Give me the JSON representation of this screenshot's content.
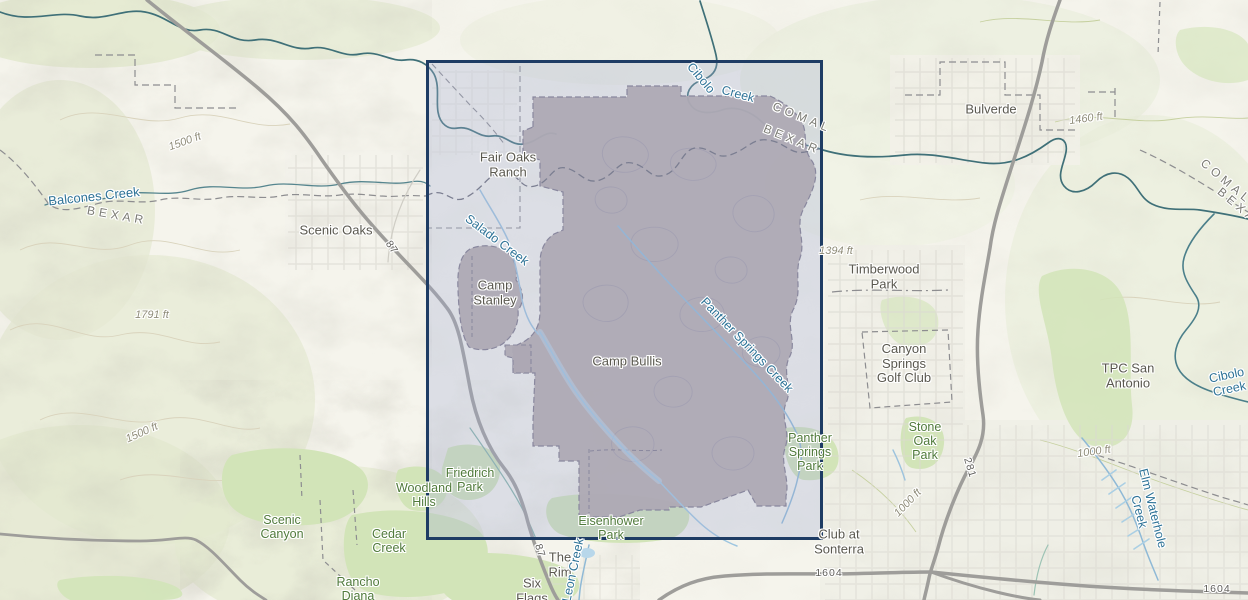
{
  "map": {
    "description_labels_note": "topographic basemap labels visible in viewport",
    "colors": {
      "selection_border": "#1e3c64",
      "selection_fill": "rgba(163,173,212,0.30)",
      "military_polygon_fill": "#b2a8a6",
      "water_label": "#2e7397",
      "park_label": "#507a3b",
      "place_label": "#5a584f",
      "county_label": "#7b7b74",
      "elevation_label": "#8f8c79",
      "road_line": "#9e9d9a",
      "park_fill": "#d2e4b8",
      "creek_line": "#3f7078"
    }
  },
  "map_labels": [
    {
      "name": "balcones-creek",
      "cls": "water",
      "text": "Balcones Creek",
      "x": 94,
      "y": 197,
      "rot": -6,
      "fs": 13
    },
    {
      "name": "bexar-county-west",
      "cls": "county",
      "text": "BEXAR",
      "x": 117,
      "y": 216,
      "rot": 10
    },
    {
      "name": "scenic-oaks",
      "cls": "place",
      "text": "Scenic Oaks",
      "x": 336,
      "y": 231,
      "rot": 0
    },
    {
      "name": "elev-1791",
      "cls": "elev",
      "text": "1791 ft",
      "x": 152,
      "y": 315,
      "rot": 0
    },
    {
      "name": "elev-1500-a",
      "cls": "elev",
      "text": "1500 ft",
      "x": 185,
      "y": 142,
      "rot": -20
    },
    {
      "name": "elev-1500-b",
      "cls": "elev",
      "text": "1500 ft",
      "x": 142,
      "y": 433,
      "rot": -24
    },
    {
      "name": "fair-oaks-ranch",
      "cls": "place",
      "text": "Fair Oaks\nRanch",
      "x": 508,
      "y": 165,
      "rot": 0
    },
    {
      "name": "salado-creek",
      "cls": "water",
      "text": "Salado Creek",
      "x": 497,
      "y": 240,
      "rot": 37
    },
    {
      "name": "camp-stanley",
      "cls": "place",
      "text": "Camp\nStanley",
      "x": 495,
      "y": 293,
      "rot": 0
    },
    {
      "name": "camp-bullis",
      "cls": "place",
      "text": "Camp Bullis",
      "x": 627,
      "y": 362,
      "rot": 0
    },
    {
      "name": "cibolo-creek-top-1",
      "cls": "water",
      "text": "Cibolo",
      "x": 701,
      "y": 78,
      "rot": 50
    },
    {
      "name": "cibolo-creek-top-2",
      "cls": "water",
      "text": "Creek",
      "x": 738,
      "y": 94,
      "rot": 15
    },
    {
      "name": "comal-county-ne",
      "cls": "county",
      "text": "COMAL",
      "x": 802,
      "y": 118,
      "rot": 22
    },
    {
      "name": "bexar-county-ne",
      "cls": "county",
      "text": "BEXAR",
      "x": 792,
      "y": 140,
      "rot": 22
    },
    {
      "name": "bulverde",
      "cls": "place",
      "text": "Bulverde",
      "x": 991,
      "y": 110,
      "rot": 0
    },
    {
      "name": "elev-1460",
      "cls": "elev",
      "text": "1460 ft",
      "x": 1086,
      "y": 119,
      "rot": -8
    },
    {
      "name": "comal-county-east",
      "cls": "county",
      "text": "COMAL",
      "x": 1226,
      "y": 182,
      "rot": 40
    },
    {
      "name": "bexar-county-east",
      "cls": "county",
      "text": "BEXAR",
      "x": 1242,
      "y": 210,
      "rot": 40
    },
    {
      "name": "elev-1394",
      "cls": "elev",
      "text": "1394 ft",
      "x": 836,
      "y": 251,
      "rot": 0
    },
    {
      "name": "timberwood-park",
      "cls": "place",
      "text": "Timberwood\nPark",
      "x": 884,
      "y": 277,
      "rot": 0
    },
    {
      "name": "canyon-springs-golf-club",
      "cls": "place",
      "text": "Canyon\nSprings\nGolf Club",
      "x": 904,
      "y": 364,
      "rot": 0
    },
    {
      "name": "tpc-san-antonio",
      "cls": "place",
      "text": "TPC San\nAntonio",
      "x": 1128,
      "y": 376,
      "rot": 0
    },
    {
      "name": "cibolo-creek-right",
      "cls": "water",
      "text": "Cibolo Creek",
      "x": 1228,
      "y": 382,
      "rot": -12
    },
    {
      "name": "panther-springs-creek",
      "cls": "water",
      "text": "Panther Springs Creek",
      "x": 747,
      "y": 345,
      "rot": 46
    },
    {
      "name": "panther-springs-park",
      "cls": "park",
      "text": "Panther\nSprings\nPark",
      "x": 810,
      "y": 452,
      "rot": 0
    },
    {
      "name": "stone-oak-park",
      "cls": "park",
      "text": "Stone\nOak\nPark",
      "x": 925,
      "y": 441,
      "rot": 0
    },
    {
      "name": "elev-1000-a",
      "cls": "elev",
      "text": "1000 ft",
      "x": 1094,
      "y": 452,
      "rot": -8
    },
    {
      "name": "elev-1000-b",
      "cls": "elev",
      "text": "1000 ft",
      "x": 908,
      "y": 503,
      "rot": -46
    },
    {
      "name": "elm-waterhole-creek",
      "cls": "water",
      "text": "Elm Waterhole Creek",
      "x": 1146,
      "y": 510,
      "rot": 76
    },
    {
      "name": "route-281",
      "cls": "road",
      "text": "281",
      "x": 969,
      "y": 468,
      "rot": 73
    },
    {
      "name": "route-87-north",
      "cls": "road",
      "text": "87",
      "x": 391,
      "y": 248,
      "rot": 55
    },
    {
      "name": "route-87-south",
      "cls": "road",
      "text": "87",
      "x": 539,
      "y": 551,
      "rot": 73
    },
    {
      "name": "route-1604-west",
      "cls": "road",
      "text": "1604",
      "x": 829,
      "y": 574,
      "rot": 0
    },
    {
      "name": "route-1604-east",
      "cls": "road",
      "text": "1604",
      "x": 1217,
      "y": 590,
      "rot": 0
    },
    {
      "name": "club-at-sonterra",
      "cls": "place",
      "text": "Club at\nSonterra",
      "x": 839,
      "y": 542,
      "rot": 0
    },
    {
      "name": "eisenhower-park",
      "cls": "park",
      "text": "Eisenhower\nPark",
      "x": 611,
      "y": 528,
      "rot": 0
    },
    {
      "name": "friedrich-park",
      "cls": "park",
      "text": "Friedrich\nPark",
      "x": 470,
      "y": 480,
      "rot": 0
    },
    {
      "name": "woodland-hills",
      "cls": "park",
      "text": "Woodland\nHills",
      "x": 424,
      "y": 495,
      "rot": 0
    },
    {
      "name": "scenic-canyon",
      "cls": "park",
      "text": "Scenic\nCanyon",
      "x": 282,
      "y": 527,
      "rot": 0
    },
    {
      "name": "cedar-creek",
      "cls": "park",
      "text": "Cedar\nCreek",
      "x": 389,
      "y": 541,
      "rot": 0
    },
    {
      "name": "rancho-diana",
      "cls": "park",
      "text": "Rancho\nDiana",
      "x": 358,
      "y": 589,
      "rot": 0
    },
    {
      "name": "the-rim",
      "cls": "place",
      "text": "The\nRim",
      "x": 560,
      "y": 565,
      "rot": 0
    },
    {
      "name": "six-flags",
      "cls": "place",
      "text": "Six\nFlags",
      "x": 532,
      "y": 591,
      "rot": 0
    },
    {
      "name": "leon-creek",
      "cls": "water",
      "text": "Leon Creek",
      "x": 573,
      "y": 570,
      "rot": -78
    }
  ]
}
